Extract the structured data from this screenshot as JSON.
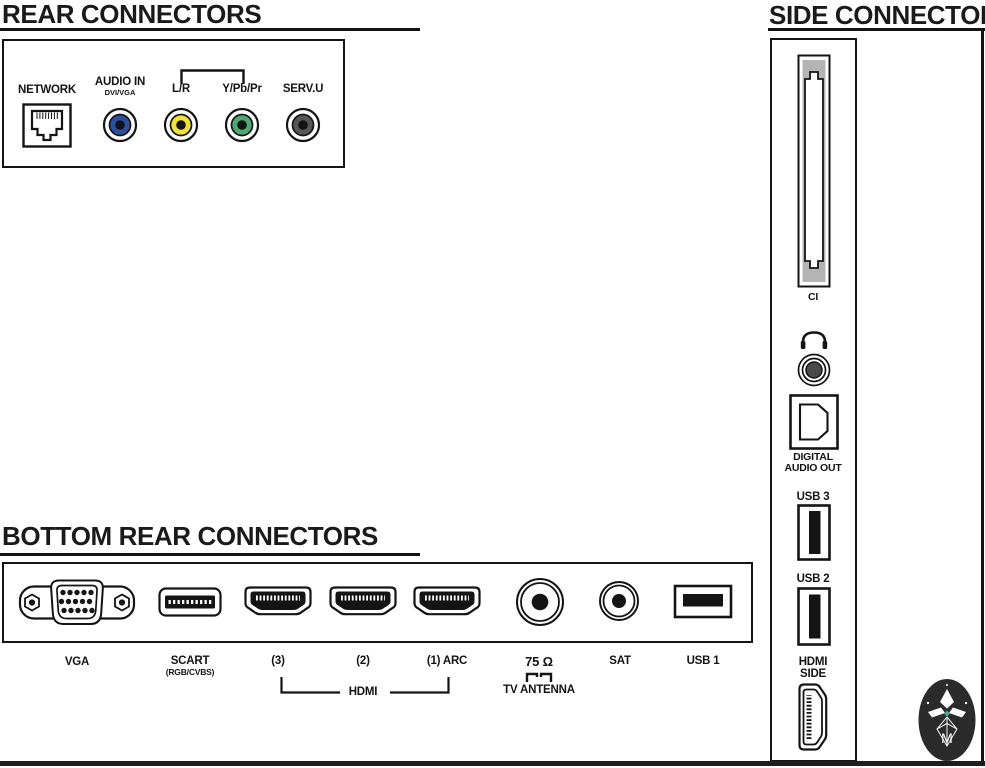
{
  "sections": {
    "rear": {
      "title": "REAR CONNECTORS",
      "connectors": {
        "network": {
          "label": "NETWORK"
        },
        "audio_in": {
          "label": "AUDIO IN",
          "sublabel": "DVI/VGA"
        },
        "lr": {
          "label": "L/R"
        },
        "ypbpr": {
          "label": "Y/Pb/Pr"
        },
        "serv": {
          "label": "SERV.U"
        }
      }
    },
    "bottom": {
      "title": "BOTTOM REAR CONNECTORS",
      "connectors": {
        "vga": {
          "label": "VGA"
        },
        "scart": {
          "label": "SCART",
          "sublabel": "(RGB/CVBS)"
        },
        "hdmi3": {
          "label": "(3)"
        },
        "hdmi2": {
          "label": "(2)"
        },
        "hdmi1": {
          "label": "(1) ARC"
        },
        "hdmi_group": {
          "label": "HDMI"
        },
        "antenna": {
          "label": "75 Ω",
          "sublabel": "TV ANTENNA"
        },
        "sat": {
          "label": "SAT"
        },
        "usb1": {
          "label": "USB 1"
        }
      }
    },
    "side": {
      "title": "SIDE CONNECTORS",
      "connectors": {
        "ci": {
          "label": "CI"
        },
        "digital_audio": {
          "label_line1": "DIGITAL",
          "label_line2": "AUDIO OUT"
        },
        "usb3": {
          "label": "USB 3"
        },
        "usb2": {
          "label": "USB 2"
        },
        "hdmi_side": {
          "label_line1": "HDMI",
          "label_line2": "SIDE"
        }
      }
    }
  },
  "logo": {
    "monogram": "M"
  },
  "colors": {
    "ink": "#141414",
    "audio_in_blue": "#2e4f9b",
    "lr_yellow": "#efe23b",
    "ypbpr_green": "#4fa772",
    "serv_gray": "#575757",
    "jack_center_gray": "#4a4a4a",
    "ci_gray": "#b4b4b4",
    "logo_bg": "#2b2b2b",
    "logo_accent": "#3fae9e",
    "bottom_band": "#1d1d1d"
  },
  "icons": {
    "rj45-network-icon": "ethernet socket outline",
    "rca-jack-icon": "concentric circles with colored ring",
    "bracket-icon": "grouping bracket line",
    "vga-port-icon": "15-pin D-sub with screw holes",
    "scart-port-icon": "rounded slot with pin bar",
    "hdmi-port-icon": "HDMI trapezoid outline",
    "coax-port-icon": "concentric circles with center pin",
    "usb-port-icon": "rectangle with contact tongue",
    "ci-slot-icon": "vertical card slot with keyed notches",
    "headphones-icon": "headphone arc with ear cups",
    "toslink-port-icon": "square with chamfered D shape",
    "manual-logo-icon": "dark oval with diamond ornament and monogram"
  }
}
